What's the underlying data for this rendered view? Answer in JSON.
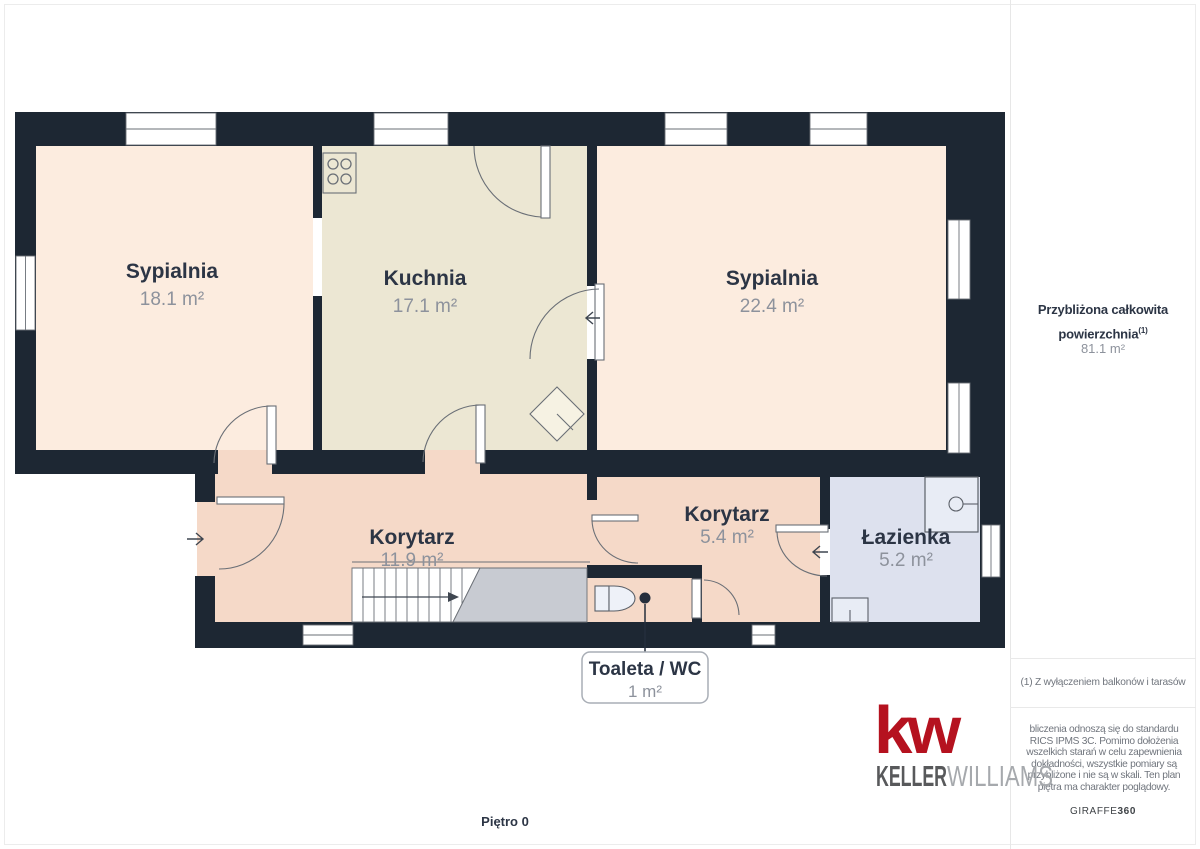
{
  "plan": {
    "floor_label": "Piętro 0",
    "rooms": [
      {
        "name": "Sypialnia",
        "area": "18.1 m²"
      },
      {
        "name": "Kuchnia",
        "area": "17.1 m²"
      },
      {
        "name": "Sypialnia",
        "area": "22.4 m²"
      },
      {
        "name": "Korytarz",
        "area": "11.9 m²"
      },
      {
        "name": "Korytarz",
        "area": "5.4 m²"
      },
      {
        "name": "Łazienka",
        "area": "5.2 m²"
      }
    ],
    "callout": {
      "title": "Toaleta / WC",
      "area": "1 m²"
    }
  },
  "sidebar": {
    "total_label_line1": "Przybliżona całkowita",
    "total_label_line2": "powierzchnia",
    "total_label_sup": "(1)",
    "total_value": "81.1 m²",
    "footnote": "(1) Z wyłączeniem balkonów i tarasów",
    "disclaimer_lines": [
      "bliczenia odnoszą się do standardu",
      "RICS IPMS 3C. Pomimo dołożenia",
      "wszelkich starań w celu zapewnienia",
      "dokładności, wszystkie pomiary są",
      "przybliżone i nie są w skali. Ten plan",
      "piętra ma charakter poglądowy."
    ]
  },
  "branding": {
    "kw_mark": "kw",
    "kw_name_primary": "KELLER",
    "kw_name_secondary": "WILLIAMS",
    "giraffe_name": "GIRAFFE",
    "giraffe_number": "360"
  },
  "colors": {
    "wall": "#1d2733",
    "bedroom_fill": "#fcecdf",
    "kitchen_fill": "#ece7d3",
    "corridor_fill": "#f5d9c8",
    "bathroom_fill": "#dde1ee",
    "stairs_fill": "#c8cbd2",
    "kw_red": "#b5121f",
    "label_dark": "#2c3545",
    "label_gray": "#8d929c"
  }
}
